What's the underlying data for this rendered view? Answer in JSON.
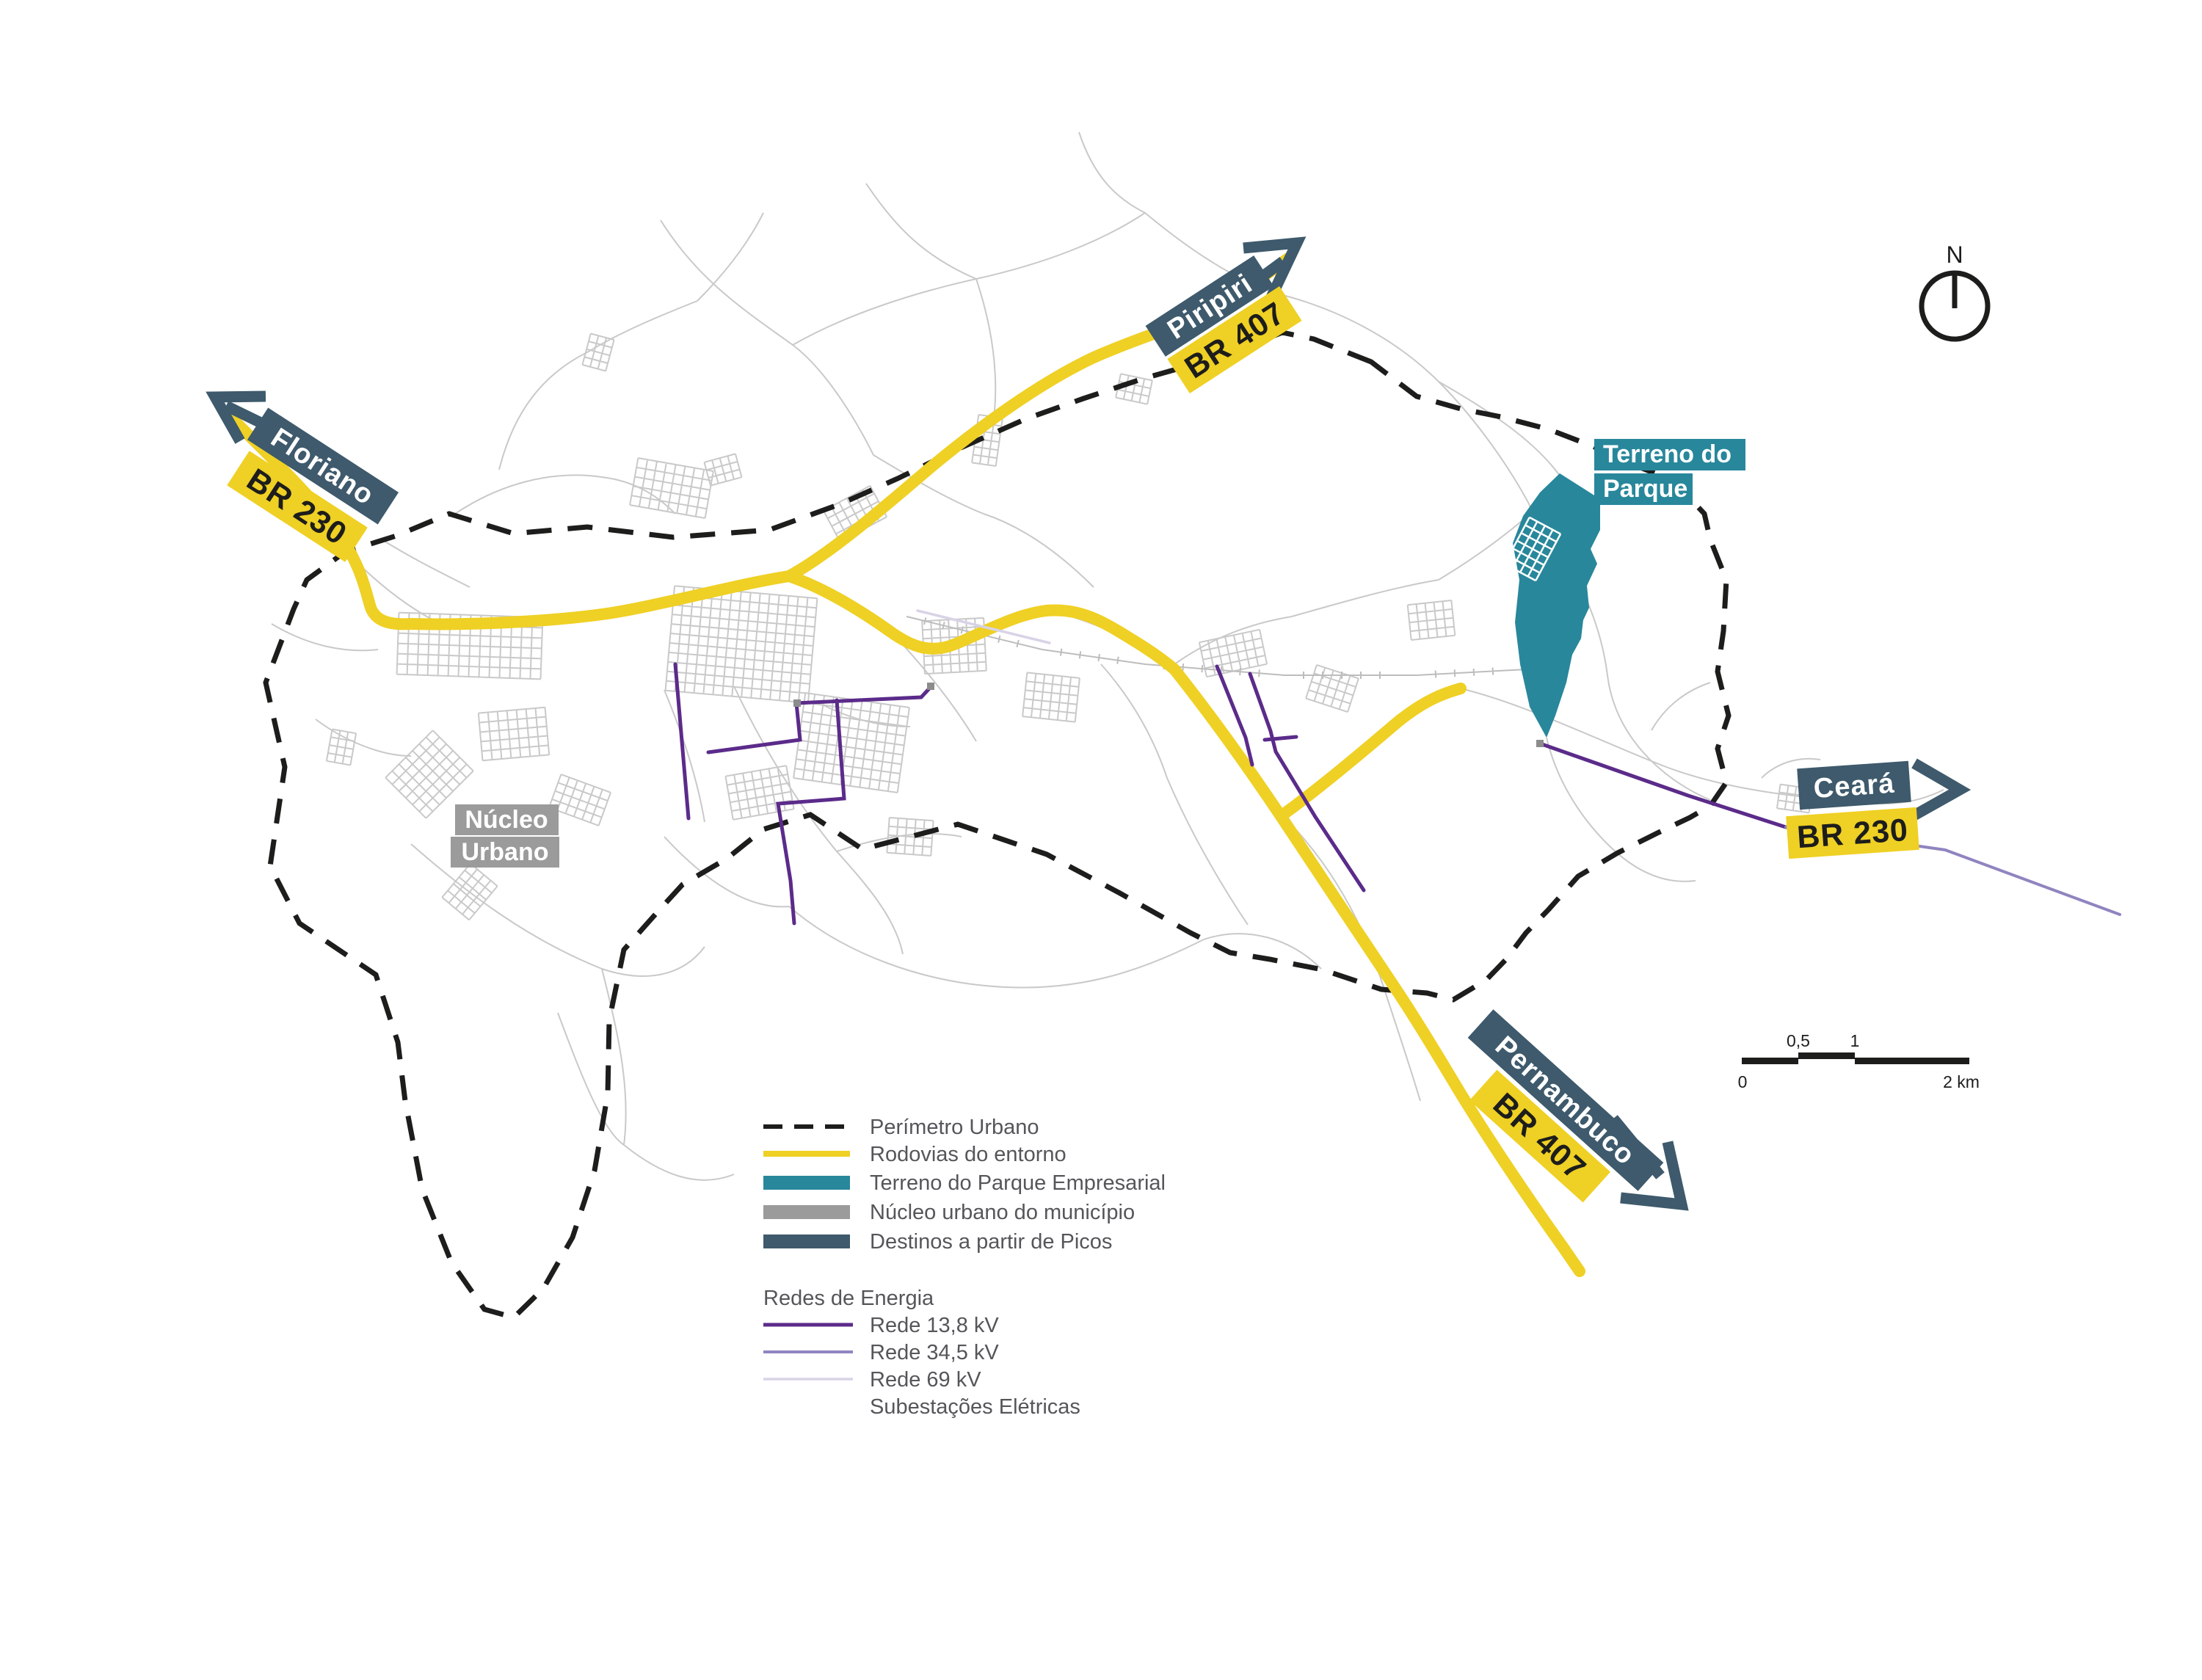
{
  "compass": {
    "label": "N"
  },
  "destinations": [
    {
      "id": "piripiri",
      "city": "Piripiri",
      "route": "BR 407"
    },
    {
      "id": "floriano",
      "city": "Floriano",
      "route": "BR 230"
    },
    {
      "id": "ceara",
      "city": "Ceará",
      "route": "BR 230"
    },
    {
      "id": "pernambuco",
      "city": "Pernambuco",
      "route": "BR 407"
    }
  ],
  "area_labels": {
    "park": {
      "line1": "Terreno do",
      "line2": "Parque"
    },
    "nucleo": {
      "line1": "Núcleo",
      "line2": "Urbano"
    }
  },
  "legend": {
    "items": [
      {
        "label": "Perímetro Urbano",
        "swatch": "dashed-line",
        "color": "#1d1d1b"
      },
      {
        "label": "Rodovias do entorno",
        "swatch": "line",
        "color": "#efd024"
      },
      {
        "label": "Terreno do Parque Empresarial",
        "swatch": "box",
        "color": "#28879b"
      },
      {
        "label": "Núcleo urbano do município",
        "swatch": "box",
        "color": "#9b9b9b"
      },
      {
        "label": "Destinos a partir de Picos",
        "swatch": "box",
        "color": "#3e5a6c"
      }
    ],
    "energy": {
      "header": "Redes de Energia",
      "items": [
        {
          "label": "Rede 13,8 kV",
          "color": "#5b2b8a"
        },
        {
          "label": "Rede 34,5 kV",
          "color": "#9184c0"
        },
        {
          "label": "Rede 69 kV",
          "color": "#d9d3e6"
        },
        {
          "label": "Subestações Elétricas",
          "color": ""
        }
      ]
    }
  },
  "scale_bar": {
    "tick0": "0",
    "tick05": "0,5",
    "tick1": "1",
    "tick2": "2 km"
  },
  "colors": {
    "highway": "#efd024",
    "park": "#28879b",
    "nucleo": "#9b9b9b",
    "destino": "#3e5a6c",
    "perimeter": "#1d1d1b",
    "streets": "#c9c9c9",
    "rede138": "#5b2b8a",
    "rede345": "#9184c0",
    "rede69": "#d9d3e6"
  }
}
